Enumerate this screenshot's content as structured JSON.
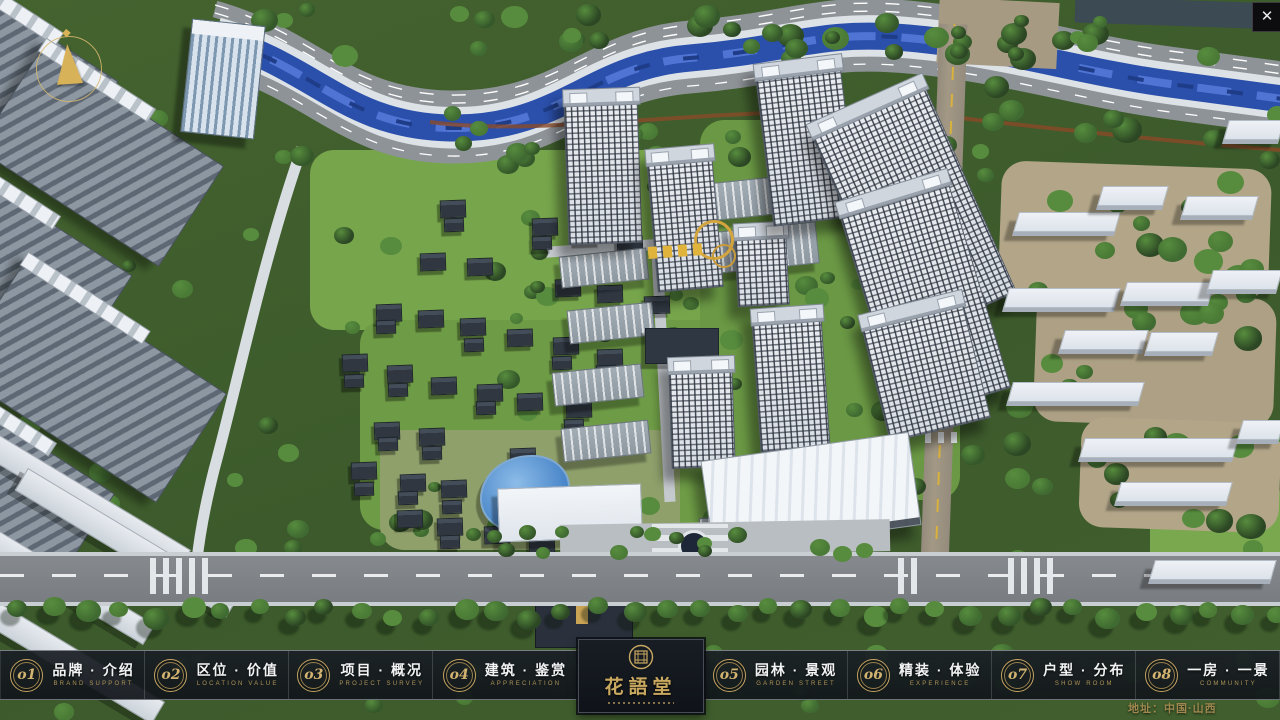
{
  "window": {
    "close_icon": "✕"
  },
  "navbar": {
    "items": [
      {
        "num": "o1",
        "label": "品牌 · 介绍",
        "sub": "BRAND SUPPORT"
      },
      {
        "num": "o2",
        "label": "区位 · 价值",
        "sub": "LOCATION VALUE"
      },
      {
        "num": "o3",
        "label": "项目 · 概况",
        "sub": "PROJECT SURVEY"
      },
      {
        "num": "o4",
        "label": "建筑 · 鉴赏",
        "sub": "APPRECIATION"
      },
      {
        "num": "o5",
        "label": "园林 · 景观",
        "sub": "GARDEN STREET"
      },
      {
        "num": "o6",
        "label": "精装 · 体验",
        "sub": "EXPERIENCE"
      },
      {
        "num": "o7",
        "label": "户型 · 分布",
        "sub": "SHOW ROOM"
      },
      {
        "num": "o8",
        "label": "一房 · 一景",
        "sub": "COMMUNITY"
      }
    ]
  },
  "logo": {
    "title": "花語堂"
  },
  "footer": {
    "address": "地址：中国·山西"
  },
  "colors": {
    "gold": "#c9a960",
    "bar_bg": "#151a20",
    "river": "#2b50ab",
    "tree": "#3f6a31"
  }
}
